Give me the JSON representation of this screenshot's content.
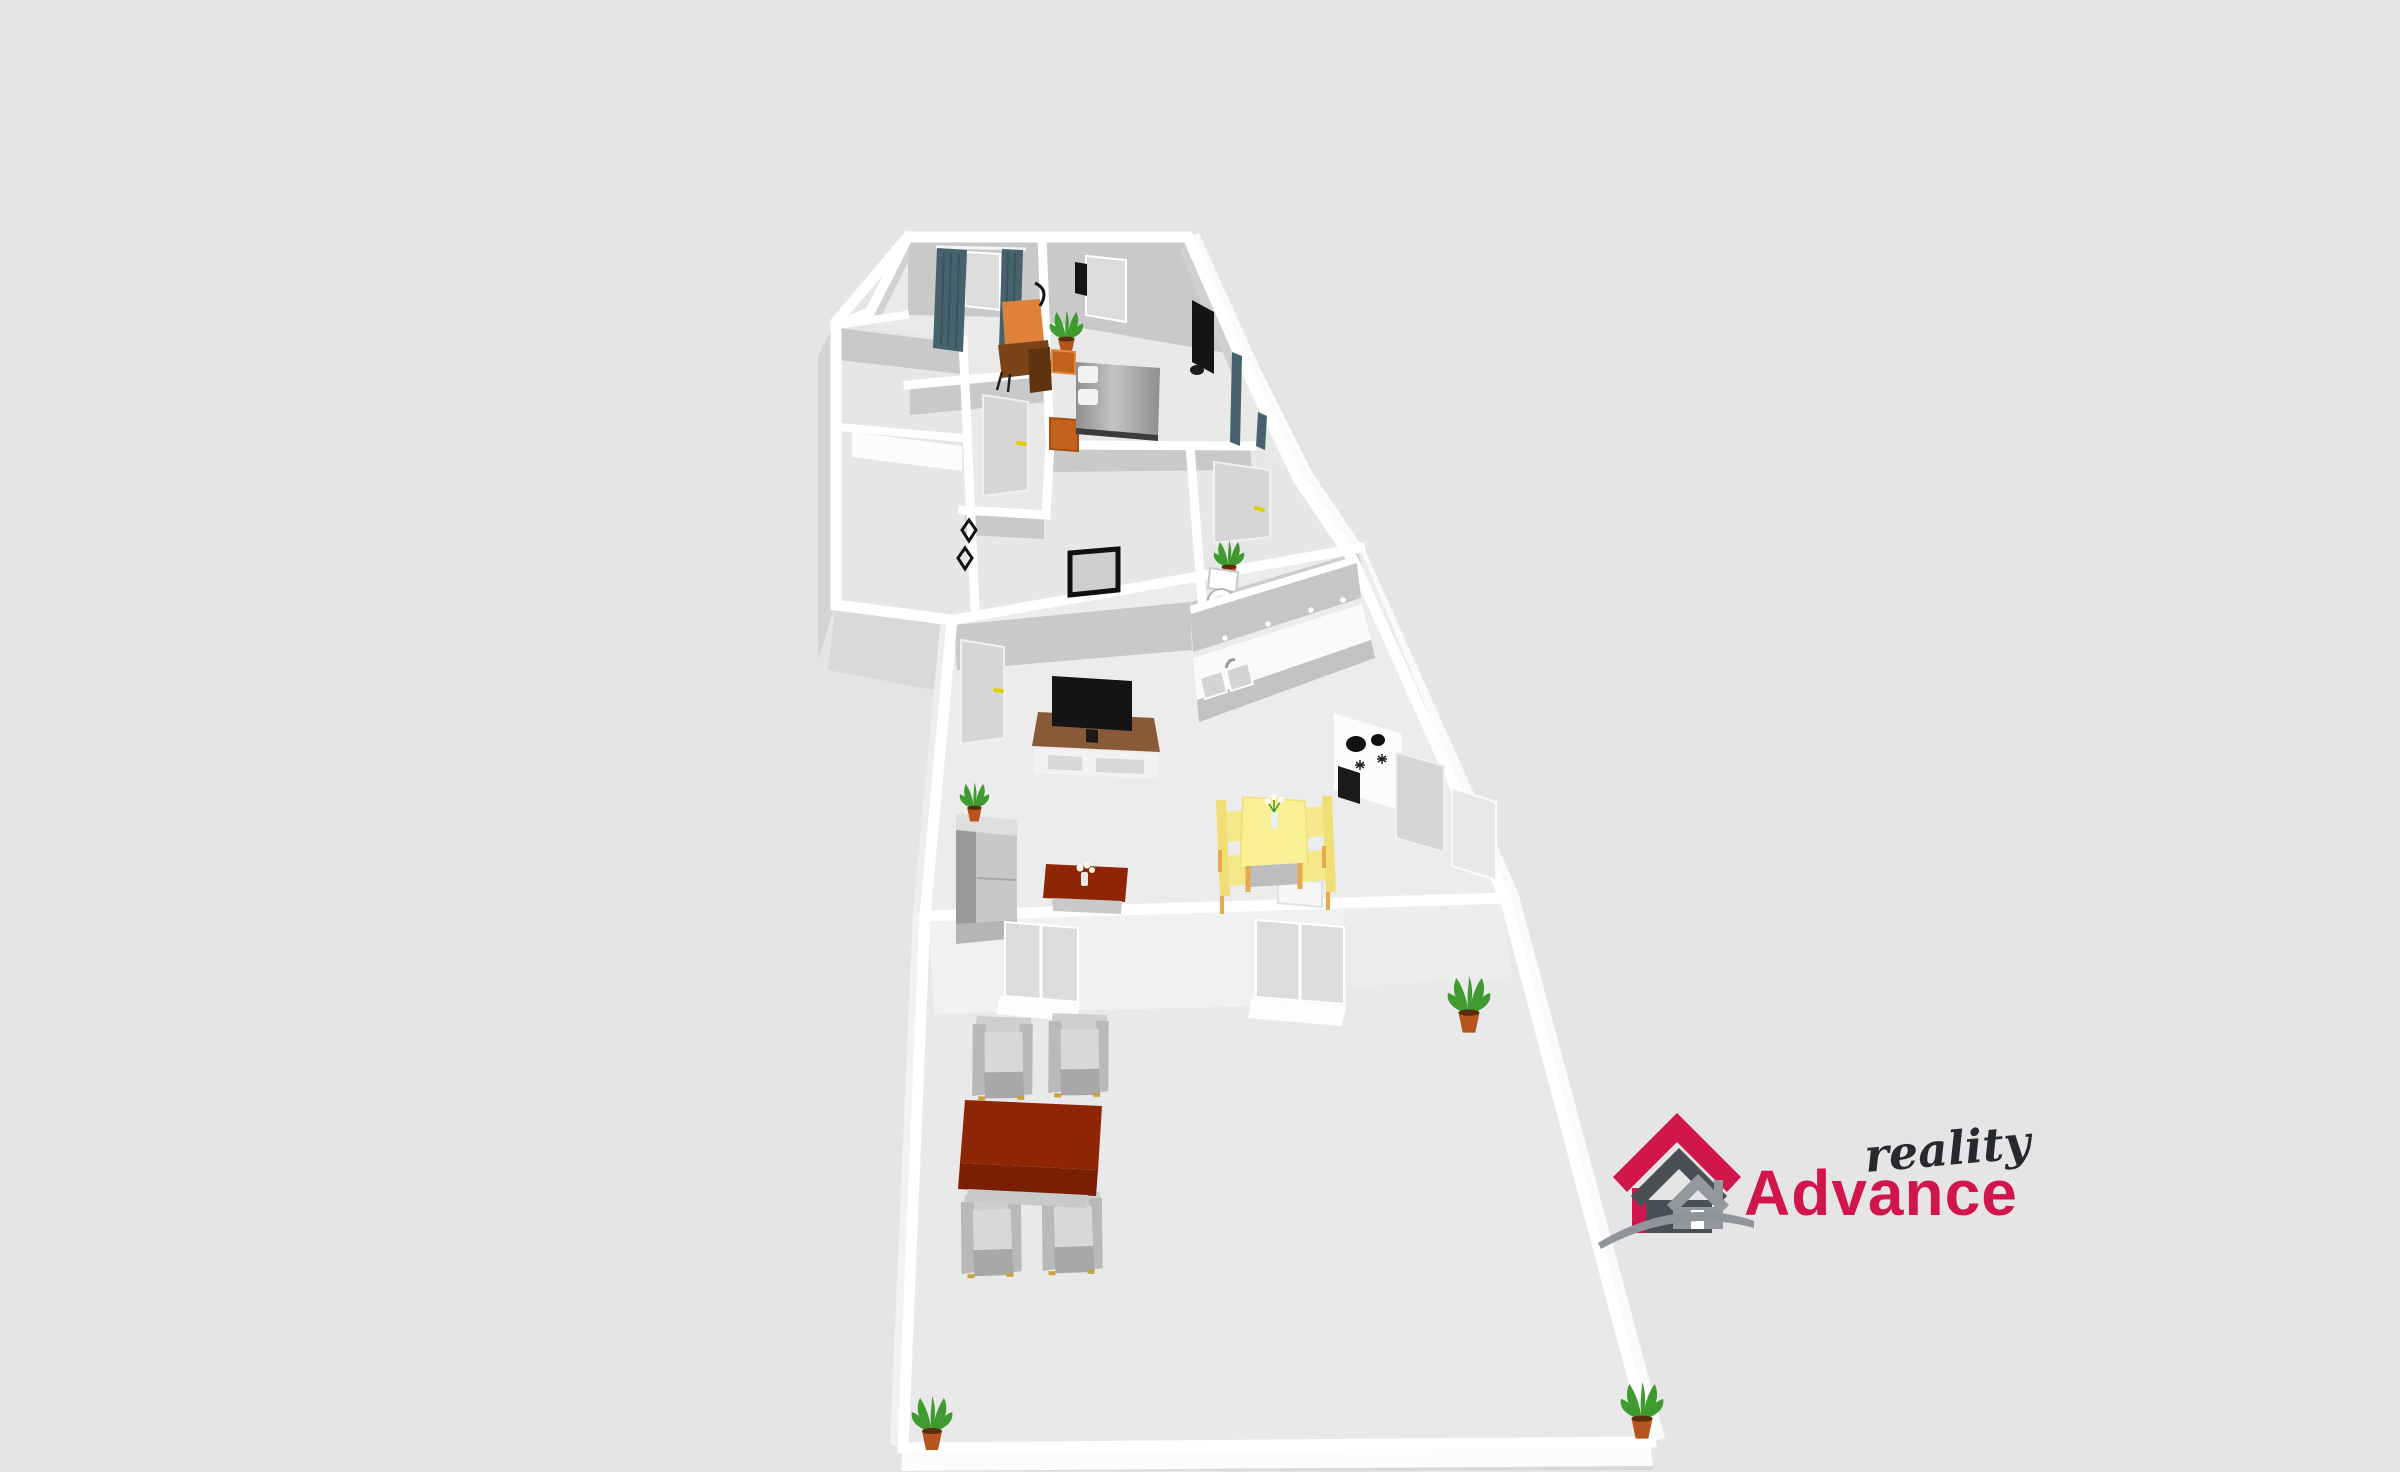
{
  "canvas": {
    "width": 2400,
    "height": 1472
  },
  "palette": {
    "background": "#e5e5e5",
    "wall": "#ffffff",
    "wall_shade": "#c9c9c9",
    "floor": "#ebebeb",
    "door_gray": "#d6d6d6",
    "glass_gray": "#dcdcdc",
    "handle_yellow": "#e6cf00",
    "curtain": "#46636d",
    "orange_wood": "#c2611c",
    "orange_wood_dark": "#a04e12",
    "chair_orange": "#e0813a",
    "desk_brown": "#7a4318",
    "bed_gray": "#b0b0b0",
    "black": "#141414",
    "stand_brown": "#8a5a38",
    "cabinet_gray": "#c6c6c6",
    "counter_white": "#fafafa",
    "table_yellow": "#f9f096",
    "chair_yellow": "#f5e88a",
    "leg_orange": "#e8a84e",
    "table_red": "#8e2505",
    "sofa_gray": "#c0c0c0",
    "armchair_gray": "#c2c2c2",
    "plant_green": "#3f9b30",
    "pot_clay": "#b5541c"
  },
  "logo": {
    "brand_text": "Advance",
    "tagline_text": "reality",
    "brand_color": "#d0164a",
    "tagline_color": "#26292e",
    "house_back_color": "#d0164a",
    "house_mid_color": "#4a4e55",
    "house_front_color": "#94989d",
    "door_color": "#ffffff",
    "swoosh_color": "#8f959a"
  }
}
